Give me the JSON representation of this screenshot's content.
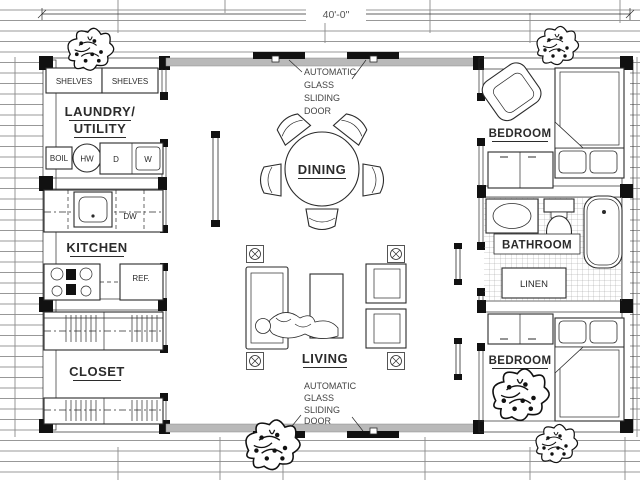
{
  "dimension": {
    "width_label": "40'-0\""
  },
  "left_unit": {
    "shelves_left": "SHELVES",
    "shelves_right": "SHELVES",
    "laundry_line1": "LAUNDRY/",
    "laundry_line2": "UTILITY",
    "boiler": "BOIL",
    "water_heater": "HW",
    "dryer": "D",
    "washer": "W",
    "dishwasher": "DW",
    "kitchen": "KITCHEN",
    "fridge": "REF.",
    "closet": "CLOSET"
  },
  "center_unit": {
    "door_note_top": [
      "AUTOMATIC",
      "GLASS",
      "SLIDING",
      "DOOR"
    ],
    "dining": "DINING",
    "living": "LIVING",
    "door_note_bottom": [
      "AUTOMATIC",
      "GLASS",
      "SLIDING",
      "DOOR"
    ]
  },
  "right_unit": {
    "bedroom_top": "BEDROOM",
    "bathroom": "BATHROOM",
    "linen": "LINEN",
    "bedroom_bottom": "BEDROOM"
  },
  "colors": {
    "ink": "#2b2b2b",
    "paper": "#ffffff",
    "glass_wall": "#b9b9b9",
    "door_panel": "#111111",
    "deck_line": "#8c8c8c",
    "tile_line": "#9a9a9a"
  }
}
